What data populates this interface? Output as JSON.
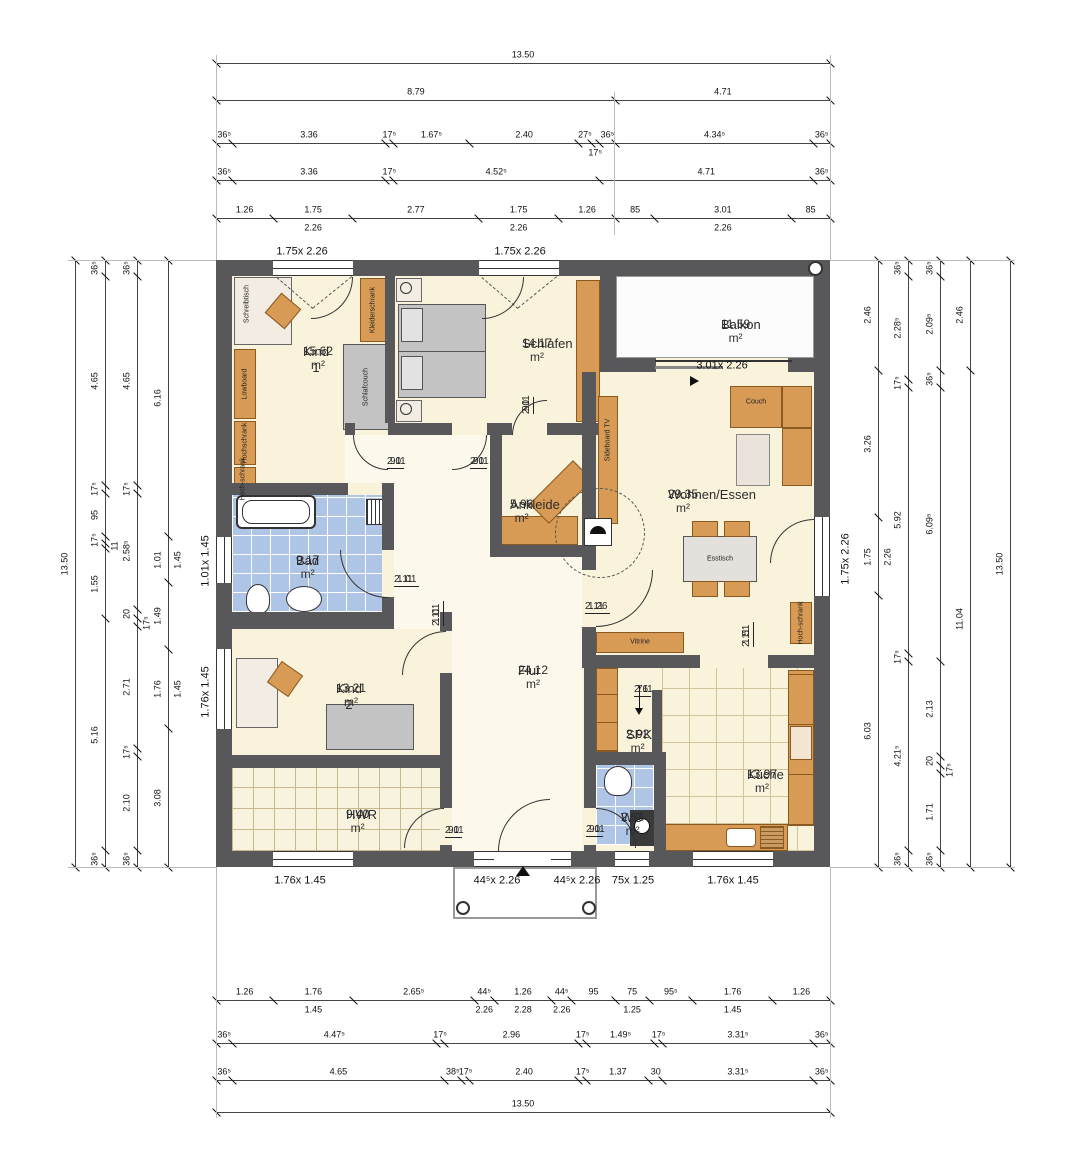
{
  "rooms": {
    "kind1": {
      "name": "Kind 1",
      "area": "15.62 m²"
    },
    "schlafen": {
      "name": "Schlafen",
      "area": "14.17 m²"
    },
    "balkon": {
      "name": "Balkon",
      "area": "11.59 m²"
    },
    "wohnen": {
      "name": "Wohnen/Essen",
      "area": "29.35 m²"
    },
    "ankleide": {
      "name": "Ankleide",
      "area": "5.96 m²"
    },
    "bad": {
      "name": "Bad",
      "area": "9.17 m²"
    },
    "kind2": {
      "name": "Kind 2",
      "area": "13.21 m²"
    },
    "flur": {
      "name": "Flur",
      "area": "24.12 m²"
    },
    "spk": {
      "name": "SPK",
      "area": "2.92 m²"
    },
    "kueche": {
      "name": "Küche",
      "area": "13.97 m²"
    },
    "wc": {
      "name": "WC",
      "area": "2.56 m²"
    },
    "hwr": {
      "name": "HWR",
      "area": "9.40 m²"
    }
  },
  "furniture": {
    "schreibtisch": "Schreibtisch",
    "lowboard": "Lowboard",
    "hochschrank": "Hochschrank",
    "hochschrank2": "Hoch-schrank",
    "kleiderschrank": "Kleiderschrank",
    "schlafcouch": "Schlafcouch",
    "sideboard_tv": "Sideboard TV",
    "couch": "Couch",
    "esstisch": "Esstisch",
    "vitrine": "Vitrine",
    "hochschrank_k": "Hoch-schrank"
  },
  "window_labels": [
    "1.75x 2.26",
    "1.75x 2.26",
    "3.01x 2.26",
    "1.75x 2.26",
    "1.01x 1.45",
    "1.76x 1.45",
    "1.76x 1.45",
    "44⁵x 2.26",
    "44⁵x 2.26",
    "75x 1.25",
    "1.76x 1.45"
  ],
  "door_labels": [
    {
      "w": "90",
      "h": "2.11"
    },
    {
      "w": "90",
      "h": "2.11"
    },
    {
      "w": "90",
      "h": "2.11"
    },
    {
      "w": "1.01",
      "h": "2.11"
    },
    {
      "w": "1.01",
      "h": "2.11"
    },
    {
      "w": "1.26",
      "h": "2.11"
    },
    {
      "w": "90",
      "h": "2.11"
    },
    {
      "w": "90",
      "h": "2.11"
    },
    {
      "w": "76",
      "h": "2.11"
    },
    {
      "w": "1.51",
      "h": "2.11"
    }
  ],
  "dims": {
    "t1": [
      {
        "label": "13.50",
        "m": 13.5
      }
    ],
    "t2": [
      {
        "label": "8.79",
        "m": 8.79
      },
      {
        "label": "4.71",
        "m": 4.71
      }
    ],
    "t3": [
      {
        "label": "36⁵",
        "m": 0.365
      },
      {
        "label": "3.36",
        "m": 3.36
      },
      {
        "label": "17⁵",
        "m": 0.175
      },
      {
        "label": "1.67⁵",
        "m": 1.675
      },
      {
        "label": "2.40",
        "m": 2.4
      },
      {
        "label": "27⁵",
        "m": 0.275
      },
      {
        "label": "17⁵",
        "m": 0.175,
        "drop": true
      },
      {
        "label": "36⁵",
        "m": 0.365
      },
      {
        "label": "4.34⁵",
        "m": 4.345
      },
      {
        "label": "36⁵",
        "m": 0.365
      }
    ],
    "t4": [
      {
        "label": "36⁵",
        "m": 0.365
      },
      {
        "label": "3.36",
        "m": 3.36
      },
      {
        "label": "17⁵",
        "m": 0.175
      },
      {
        "label": "4.52⁵",
        "m": 4.525
      },
      {
        "label": "4.71",
        "m": 4.71
      },
      {
        "label": "36⁵",
        "m": 0.365
      }
    ],
    "t5": [
      {
        "label": "1.26",
        "m": 1.26
      },
      {
        "label": "1.75",
        "m": 1.75,
        "sub": "2.26"
      },
      {
        "label": "2.77",
        "m": 2.77
      },
      {
        "label": "1.75",
        "m": 1.75,
        "sub": "2.26"
      },
      {
        "label": "1.26",
        "m": 1.26
      },
      {
        "label": "85",
        "m": 0.85
      },
      {
        "label": "3.01",
        "m": 3.01,
        "sub": "2.26"
      },
      {
        "label": "85",
        "m": 0.85
      }
    ],
    "b1": [
      {
        "label": "1.26",
        "m": 1.26
      },
      {
        "label": "1.76",
        "m": 1.76,
        "sub": "1.45"
      },
      {
        "label": "2.65⁵",
        "m": 2.655
      },
      {
        "label": "44⁵",
        "m": 0.445,
        "sub": "2.26"
      },
      {
        "label": "1.26",
        "m": 1.26,
        "sub": "2.28"
      },
      {
        "label": "44⁵",
        "m": 0.445,
        "sub": "2.26"
      },
      {
        "label": "95",
        "m": 0.95
      },
      {
        "label": "75",
        "m": 0.75,
        "sub": "1.25"
      },
      {
        "label": "95⁵",
        "m": 0.955
      },
      {
        "label": "1.76",
        "m": 1.76,
        "sub": "1.45"
      },
      {
        "label": "1.26",
        "m": 1.26
      }
    ],
    "b2": [
      {
        "label": "36⁵",
        "m": 0.365
      },
      {
        "label": "4.47⁵",
        "m": 4.475
      },
      {
        "label": "17⁵",
        "m": 0.175
      },
      {
        "label": "2.96",
        "m": 2.96
      },
      {
        "label": "17⁵",
        "m": 0.175
      },
      {
        "label": "1.49⁵",
        "m": 1.495
      },
      {
        "label": "17⁵",
        "m": 0.175
      },
      {
        "label": "3.31⁵",
        "m": 3.315
      },
      {
        "label": "36⁵",
        "m": 0.365
      }
    ],
    "b3": [
      {
        "label": "36⁵",
        "m": 0.365
      },
      {
        "label": "4.65",
        "m": 4.65
      },
      {
        "label": "38⁵",
        "m": 0.385
      },
      {
        "label": "17⁵",
        "m": 0.175
      },
      {
        "label": "2.40",
        "m": 2.4
      },
      {
        "label": "17⁵",
        "m": 0.175
      },
      {
        "label": "1.37",
        "m": 1.37
      },
      {
        "label": "30",
        "m": 0.3
      },
      {
        "label": "3.31⁵",
        "m": 3.315
      },
      {
        "label": "36⁵",
        "m": 0.365
      }
    ],
    "b4": [
      {
        "label": "13.50",
        "m": 13.5
      }
    ],
    "l1": [
      {
        "label": "13.50",
        "m": 13.5
      }
    ],
    "l2": [
      {
        "label": "36⁵",
        "m": 0.365
      },
      {
        "label": "4.65",
        "m": 4.65
      },
      {
        "label": "17⁵",
        "m": 0.175
      },
      {
        "label": "95",
        "m": 0.95
      },
      {
        "label": "17⁵",
        "m": 0.175
      },
      {
        "label": "11",
        "m": 0.11,
        "drop": true
      },
      {
        "label": "1.55",
        "m": 1.55
      },
      {
        "label": "5.16",
        "m": 5.16
      },
      {
        "label": "36⁵",
        "m": 0.365
      }
    ],
    "l3": [
      {
        "label": "36⁵",
        "m": 0.365
      },
      {
        "label": "4.65",
        "m": 4.65
      },
      {
        "label": "17⁵",
        "m": 0.175
      },
      {
        "label": "2.58⁵",
        "m": 2.585
      },
      {
        "label": "20",
        "m": 0.2
      },
      {
        "label": "17⁵",
        "m": 0.175,
        "drop": true
      },
      {
        "label": "2.71",
        "m": 2.71
      },
      {
        "label": "17⁵",
        "m": 0.175
      },
      {
        "label": "2.10",
        "m": 2.1
      },
      {
        "label": "36⁵",
        "m": 0.365
      }
    ],
    "l4": [
      {
        "label": "6.16",
        "m": 6.16
      },
      {
        "label": "1.01",
        "m": 1.01,
        "sub": "1.45"
      },
      {
        "label": "1.49",
        "m": 1.49
      },
      {
        "label": "1.76",
        "m": 1.76,
        "sub": "1.45"
      },
      {
        "label": "3.08",
        "m": 3.08
      }
    ],
    "r1": [
      {
        "label": "2.46",
        "m": 2.46
      },
      {
        "label": "3.26",
        "m": 3.26
      },
      {
        "label": "1.75",
        "m": 1.75,
        "sub": "2.26"
      },
      {
        "label": "6.03",
        "m": 6.03
      }
    ],
    "r2": [
      {
        "label": "36⁵",
        "m": 0.365
      },
      {
        "label": "2.28⁵",
        "m": 2.285
      },
      {
        "label": "17⁵",
        "m": 0.175
      },
      {
        "label": "5.92",
        "m": 5.92
      },
      {
        "label": "17⁵",
        "m": 0.175
      },
      {
        "label": "4.21⁵",
        "m": 4.215
      },
      {
        "label": "36⁵",
        "m": 0.365
      }
    ],
    "r3": [
      {
        "label": "36⁵",
        "m": 0.365
      },
      {
        "label": "2.09⁵",
        "m": 2.095
      },
      {
        "label": "36⁵",
        "m": 0.365
      },
      {
        "label": "6.09⁵",
        "m": 6.095
      },
      {
        "label": "2.13",
        "m": 2.13
      },
      {
        "label": "20",
        "m": 0.2
      },
      {
        "label": "17⁵",
        "m": 0.175,
        "drop": true
      },
      {
        "label": "1.71",
        "m": 1.71
      },
      {
        "label": "36⁵",
        "m": 0.365
      }
    ],
    "r4": [
      {
        "label": "2.46",
        "m": 2.46
      },
      {
        "label": "11.04",
        "m": 11.04
      }
    ],
    "r5": [
      {
        "label": "13.50",
        "m": 13.5
      }
    ]
  },
  "colors": {
    "wall": "#58585B",
    "tile_blue": "#AFC5E6",
    "furniture": "#D89B55",
    "room_fill": "#FAF3DC"
  }
}
